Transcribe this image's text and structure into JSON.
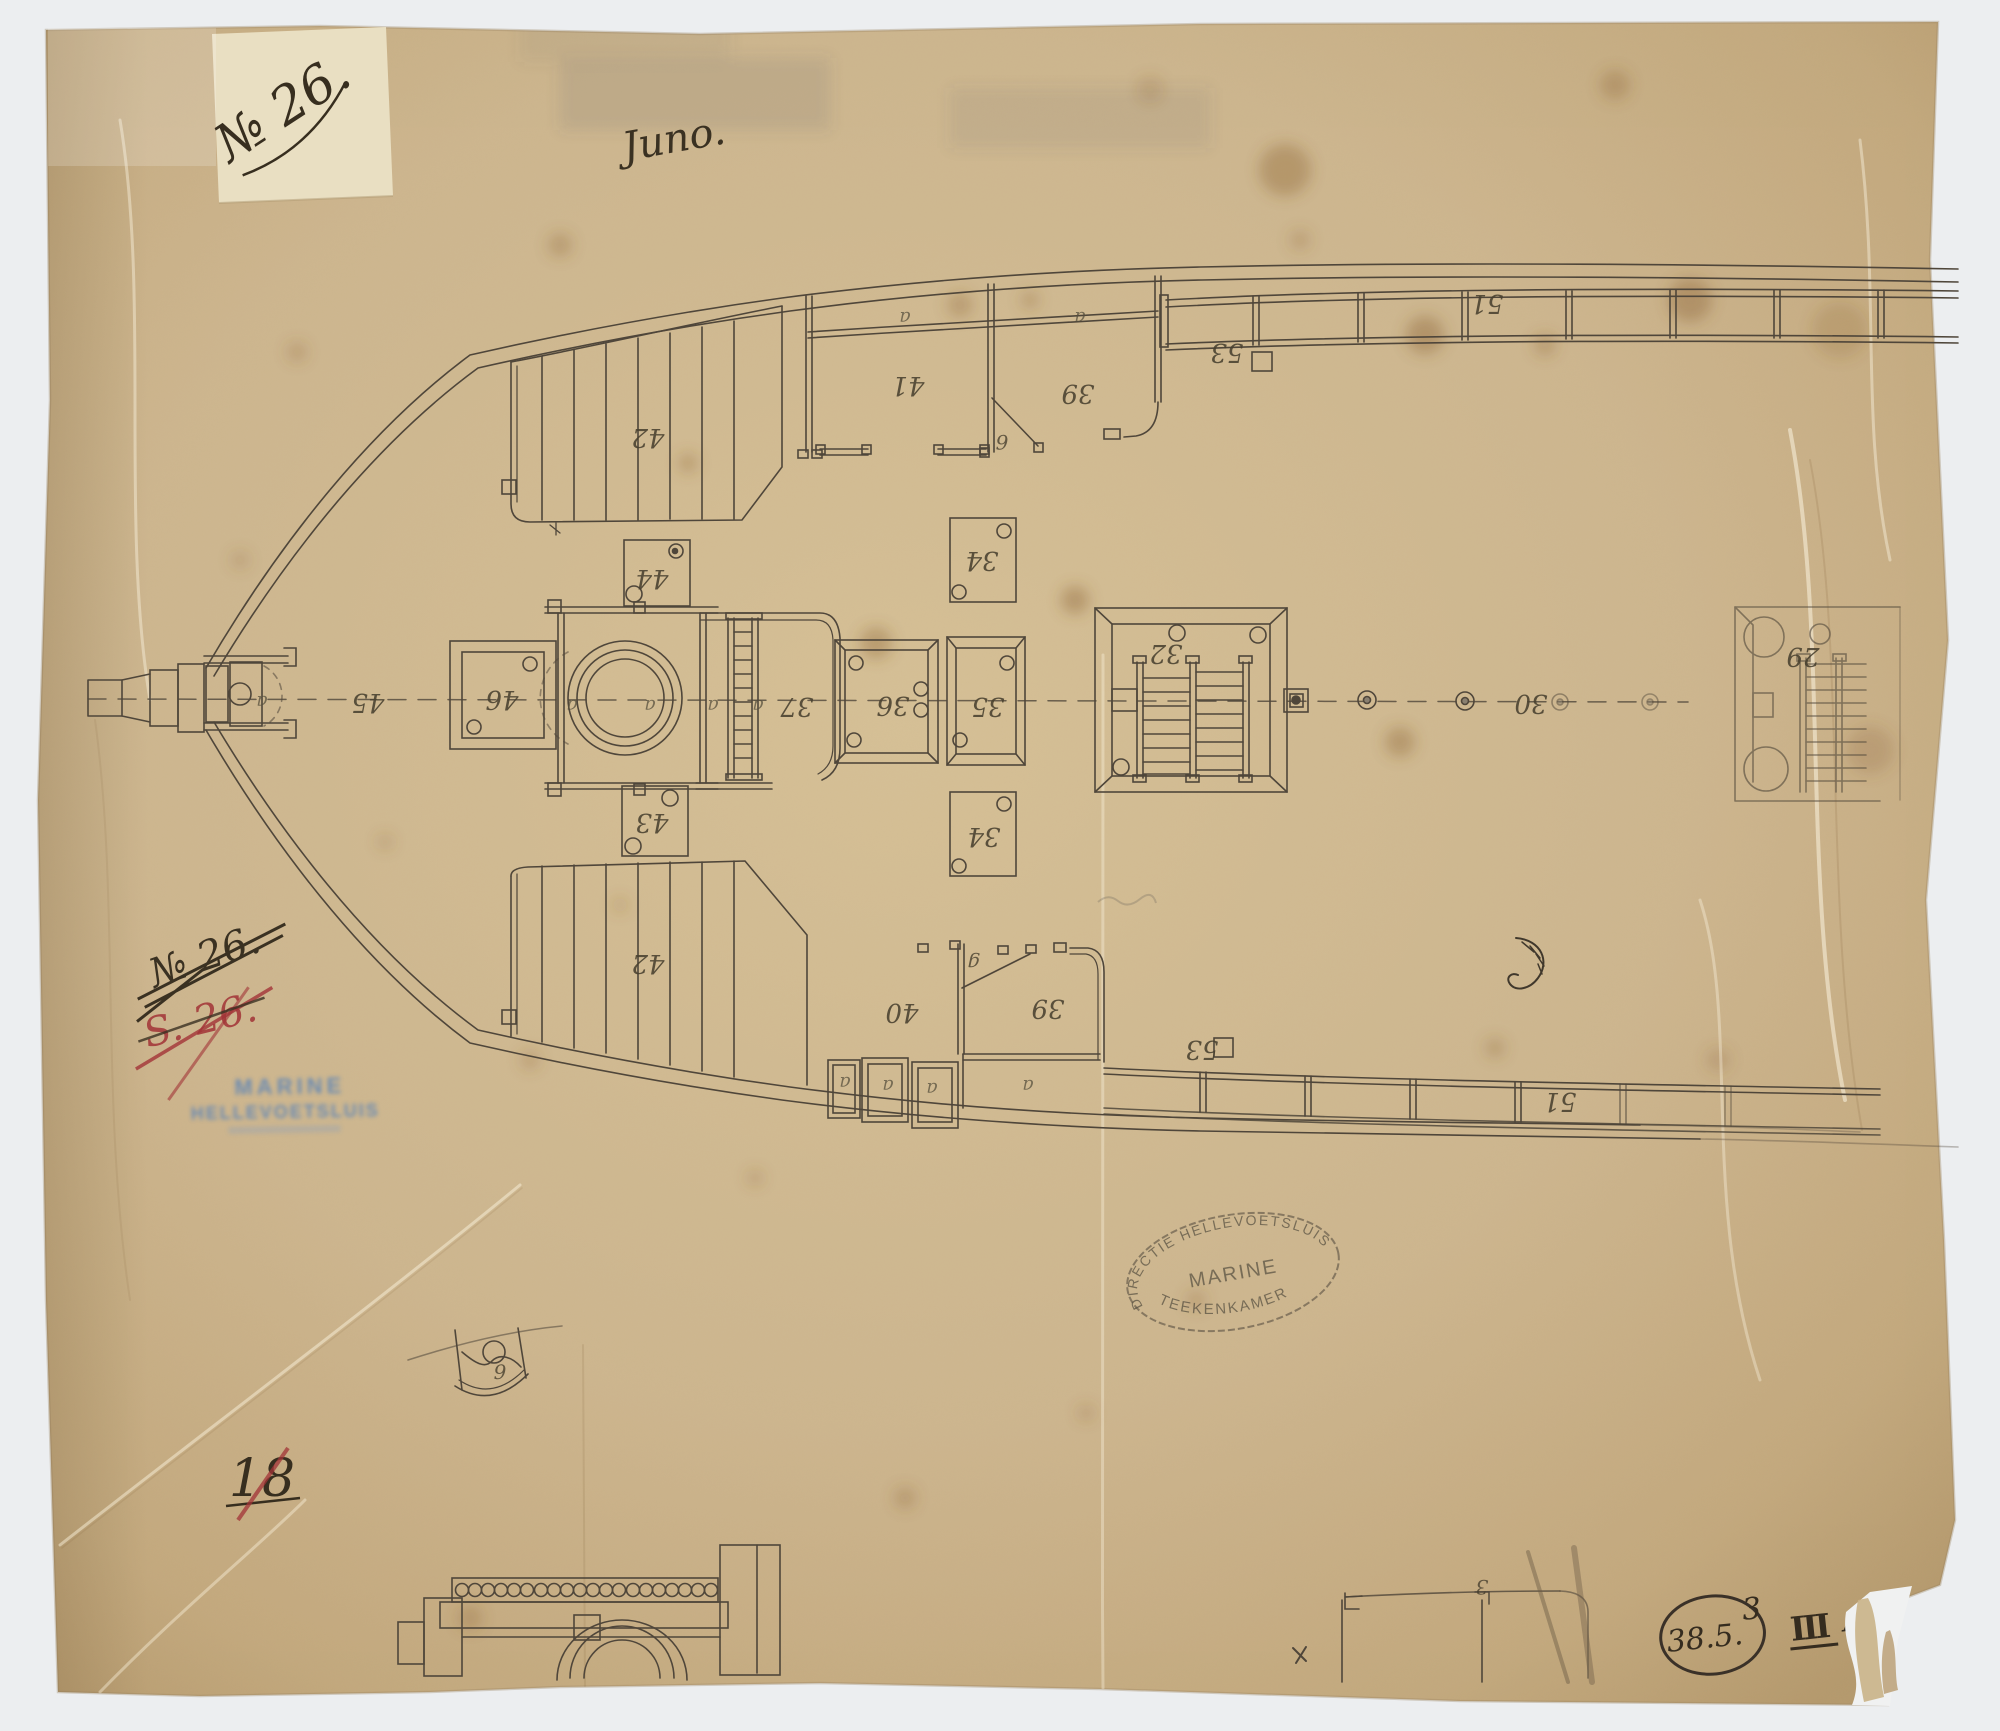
{
  "colors": {
    "paper": "#cdb68f",
    "ink": "#4f463a",
    "stamp_blue": "#5b84b8",
    "red_ink": "#a23337",
    "background": "#eceef0"
  },
  "annotations": {
    "archive_label": "№ 26.",
    "title": "Juno.",
    "struck_ink": "№ 26.",
    "struck_red": "S. 26.",
    "inventory_number": "18",
    "shelf_mark": "38.5.",
    "shelf_mark_sup": "3",
    "shelf_suffix_roman": "III",
    "shelf_suffix_letters": "AA"
  },
  "stamps": {
    "blue_line1": "MARINE",
    "blue_line2": "HELLEVOETSLUIS",
    "oval_top": "DIRECTIE HELLEVOETSLUIS",
    "oval_middle": "MARINE",
    "oval_bottom": "TEEKENKAMER"
  },
  "plan": {
    "labels": [
      {
        "text": "42"
      },
      {
        "text": "41"
      },
      {
        "text": "a"
      },
      {
        "text": "a"
      },
      {
        "text": "39"
      },
      {
        "text": "53"
      },
      {
        "text": "51"
      },
      {
        "text": "6"
      },
      {
        "text": "44"
      },
      {
        "text": "45"
      },
      {
        "text": "a"
      },
      {
        "text": "46"
      },
      {
        "text": "a"
      },
      {
        "text": "a"
      },
      {
        "text": "a"
      },
      {
        "text": "a"
      },
      {
        "text": "37"
      },
      {
        "text": "36"
      },
      {
        "text": "35"
      },
      {
        "text": "34"
      },
      {
        "text": "32"
      },
      {
        "text": "30"
      },
      {
        "text": "29"
      },
      {
        "text": "34"
      },
      {
        "text": "43"
      },
      {
        "text": "42"
      },
      {
        "text": "40"
      },
      {
        "text": "g"
      },
      {
        "text": "39"
      },
      {
        "text": "a"
      },
      {
        "text": "a"
      },
      {
        "text": "a"
      },
      {
        "text": "a"
      },
      {
        "text": "53"
      },
      {
        "text": "51"
      },
      {
        "text": "9"
      },
      {
        "text": "3"
      }
    ]
  }
}
